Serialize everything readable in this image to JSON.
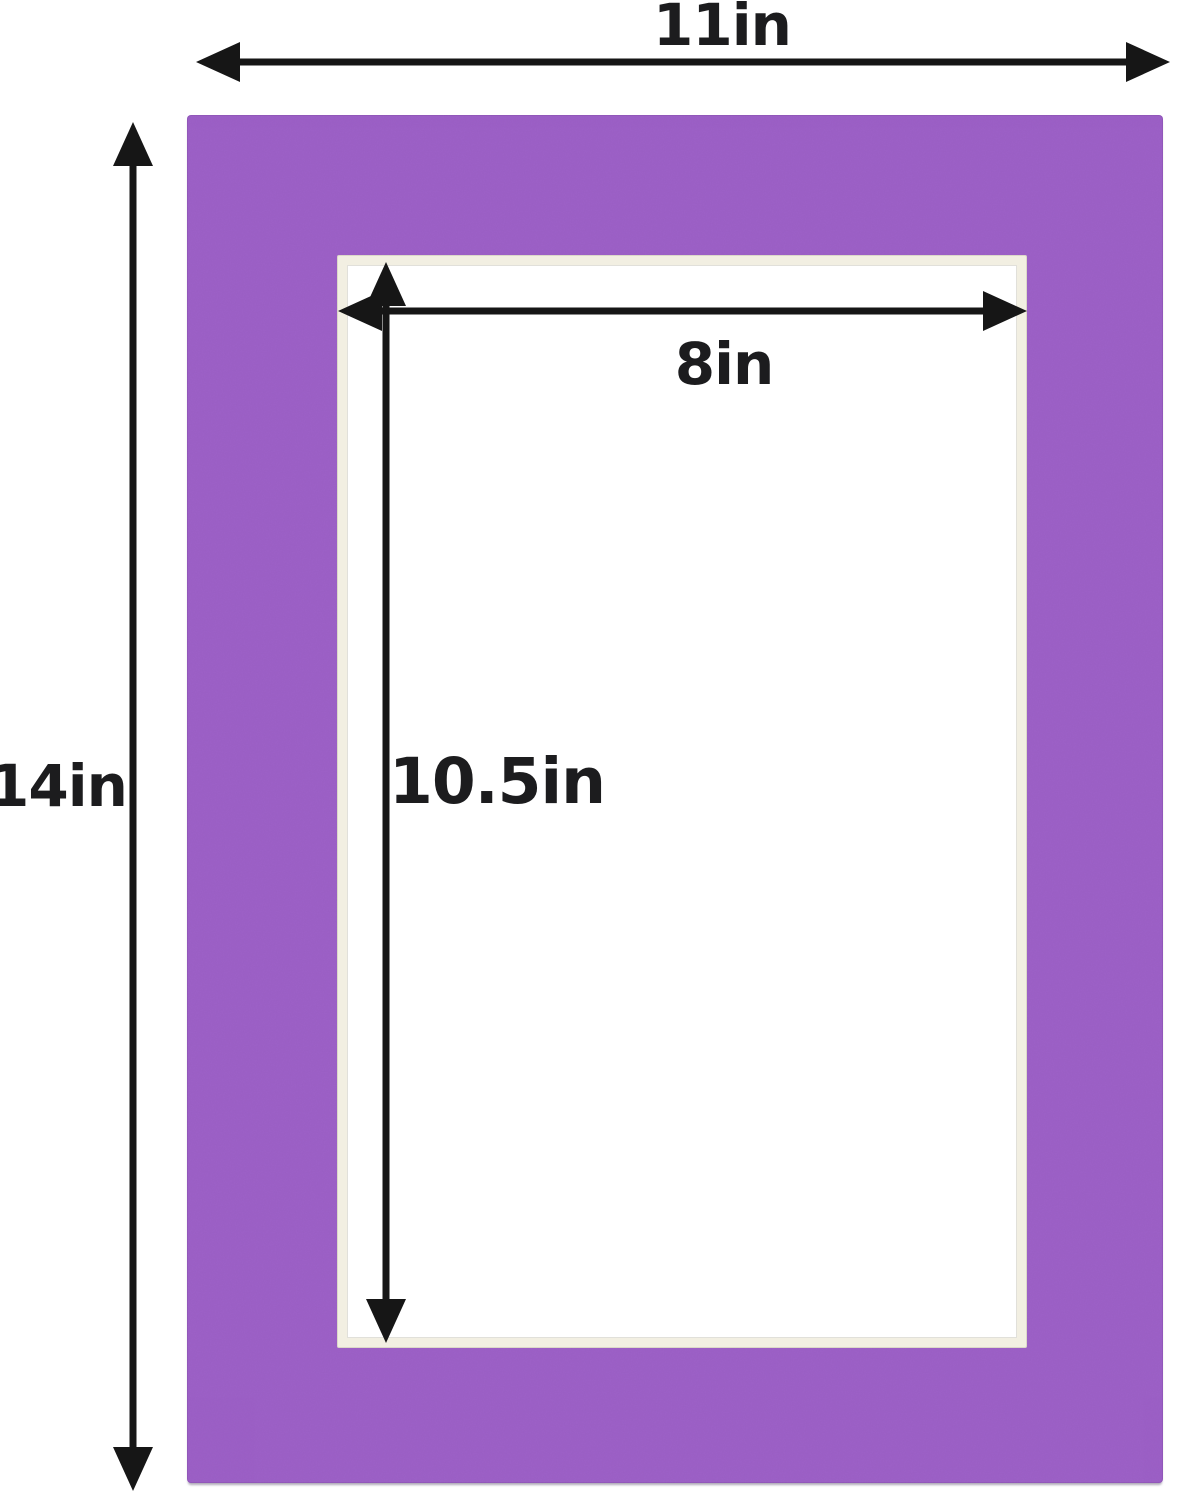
{
  "diagram": {
    "description": "Purple picture-frame mat board with cut opening and dimension arrows",
    "outer": {
      "width_label": "11in",
      "height_label": "14in"
    },
    "opening": {
      "width_label": "8in",
      "height_label": "10.5in"
    },
    "colors": {
      "mat_purple": "#9d61c8",
      "opening_bevel_cream": "#f2efe2",
      "opening_window_white": "#ffffff",
      "arrow_black": "#161616",
      "background": "#ffffff",
      "label_text": "#1c1c1e"
    }
  }
}
